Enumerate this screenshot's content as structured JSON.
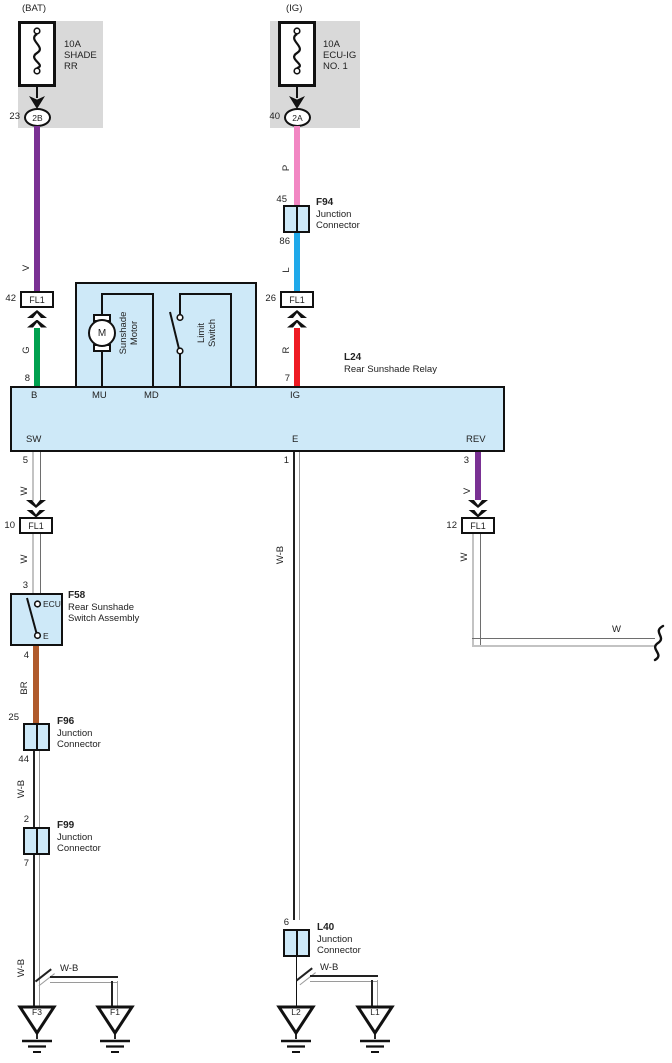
{
  "colors": {
    "violet": "#7a3194",
    "green": "#00a14f",
    "pink": "#f287c3",
    "blue": "#1fa9ea",
    "red": "#ee1b23",
    "brown": "#b05a2b",
    "panel": "#cee9f8",
    "graybox": "#d9d9d9"
  },
  "fuse_bat": {
    "header": "(BAT)",
    "rating": "10A",
    "name_line1": "SHADE",
    "name_line2": "RR",
    "pin": "23",
    "connector": "2B"
  },
  "fuse_ig": {
    "header": "(IG)",
    "rating": "10A",
    "name_line1": "ECU-IG",
    "name_line2": "NO. 1",
    "pin": "40",
    "connector": "2A"
  },
  "common": {
    "fl1": "FL1"
  },
  "bat_branch": {
    "wire_v": "V",
    "pin_42": "42",
    "wire_g": "G",
    "pin_8": "8"
  },
  "ig_branch": {
    "wire_p": "P",
    "pin_45": "45",
    "jc_f94": {
      "id": "F94",
      "line1": "Junction",
      "line2": "Connector"
    },
    "pin_86": "86",
    "wire_l": "L",
    "pin_26": "26",
    "wire_r": "R",
    "pin_7": "7"
  },
  "relay": {
    "id": "L24",
    "name": "Rear Sunshade Relay",
    "pin_b": "B",
    "pin_mu": "MU",
    "pin_md": "MD",
    "pin_ig": "IG",
    "pin_sw": "SW",
    "pin_e": "E",
    "pin_rev": "REV",
    "motor": {
      "symbol": "M",
      "label_line1": "Sunshade",
      "label_line2": "Motor"
    },
    "limit_switch": {
      "label_line1": "Limit",
      "label_line2": "Switch"
    }
  },
  "sw_branch": {
    "pin_5": "5",
    "wire_w_upper": "W",
    "pin_10": "10",
    "wire_w_lower": "W",
    "pin_3": "3",
    "switch_f58": {
      "id": "F58",
      "name_line1": "Rear Sunshade",
      "name_line2": "Switch Assembly",
      "terminal_top": "ECU",
      "terminal_bottom": "E"
    },
    "pin_4": "4",
    "wire_br": "BR",
    "pin_25": "25",
    "jc_f96": {
      "id": "F96",
      "line1": "Junction",
      "line2": "Connector"
    },
    "pin_44": "44",
    "wire_wb_upper": "W-B",
    "pin_2": "2",
    "jc_f99": {
      "id": "F99",
      "line1": "Junction",
      "line2": "Connector"
    },
    "pin_7": "7",
    "wire_wb_lower": "W-B",
    "branch_wire": "W-B",
    "ground_left": "F3",
    "ground_right": "F1"
  },
  "e_branch": {
    "pin_1": "1",
    "wire_wb": "W-B",
    "pin_6": "6",
    "jc_l40": {
      "id": "L40",
      "line1": "Junction",
      "line2": "Connector"
    },
    "branch_wire": "W-B",
    "ground_left": "L2",
    "ground_right": "L1"
  },
  "rev_branch": {
    "pin_3": "3",
    "wire_v": "V",
    "pin_12": "12",
    "wire_w": "W",
    "wire_w_horizontal": "W"
  }
}
